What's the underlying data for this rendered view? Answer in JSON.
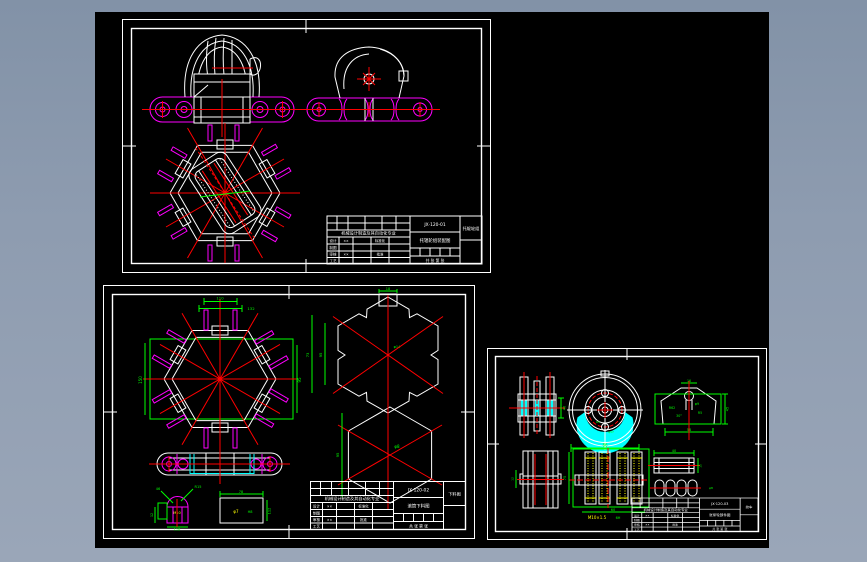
{
  "window": {
    "background": "#8e9cb0",
    "canvas_background": "#000000"
  },
  "palette": {
    "line": "#ffffff",
    "magenta": "#ff00ff",
    "red": "#ff0000",
    "green": "#00ff00",
    "cyan": "#00ffff",
    "yellow": "#ffff00"
  },
  "sheets": [
    {
      "id": "top-sheet",
      "titleblock": {
        "project": "机械设计制造及其自动化专业",
        "part_no": "JX·120-01",
        "title": "托辊轮组装配图",
        "name": "托辊轮组",
        "design": "设计",
        "draft": "制图",
        "check": "审核",
        "craft": "工艺",
        "std": "标准化",
        "approve": "批准",
        "sheet_note": "共 张  第 张",
        "sig1": "××",
        "sig2": "××"
      }
    },
    {
      "id": "bottom-left-sheet",
      "dims": {
        "hex_width": "150",
        "hex_height": "95",
        "stud_span1": "110",
        "stud_span2": "132",
        "notch_h1": "73",
        "notch_h2": "95",
        "notch_tab": "18",
        "notch_bore": "φ14",
        "hex2_h": "95",
        "hex2_bore": "φ8",
        "dome_r": "R15",
        "dome_a": "46",
        "dome_w": "118",
        "dome_t": "12",
        "dome_label": "M10",
        "rect_w": "78",
        "rect_h": "112",
        "rect_bore": "φ7",
        "rect_fit": "H8"
      },
      "titleblock": {
        "project": "机械设计制造及其自动化专业",
        "part_no": "JX·120-02",
        "title": "滚筒下料图",
        "name": "下料图",
        "design": "设计",
        "draft": "制图",
        "check": "审核",
        "craft": "工艺",
        "std": "标准化",
        "approve": "批准",
        "sheet_note": "共 张  第 张",
        "sig1": "××",
        "sig2": "××"
      }
    },
    {
      "id": "bottom-right-sheet",
      "dims": {
        "pulley_w": "40",
        "wheel_od": "86",
        "wheel_hub": "φ57",
        "wheel_r": "R4",
        "pent_top": "16",
        "pent_w": "58",
        "pent_h": "45",
        "pent_r": "R62",
        "pent_bore": "φ9",
        "pent_r2": "R5",
        "pent_ang": "30°",
        "plan_t": "12",
        "sect_h": "75",
        "sect_w": "60",
        "sect_thread": "M10×1.5",
        "sect_fit": "6H",
        "bar_l": "40",
        "bar_h": "15",
        "roller_d": "φ8"
      },
      "titleblock": {
        "project": "机械设计制造及其自动化专业",
        "part_no": "JX·120-03",
        "title": "张紧轮部件图",
        "name": "绞车",
        "design": "设计",
        "draft": "制图",
        "check": "审核",
        "craft": "工艺",
        "std": "标准化",
        "approve": "批准",
        "sheet_note": "共 张  第 张",
        "sig1": "××",
        "sig2": "××"
      }
    }
  ]
}
